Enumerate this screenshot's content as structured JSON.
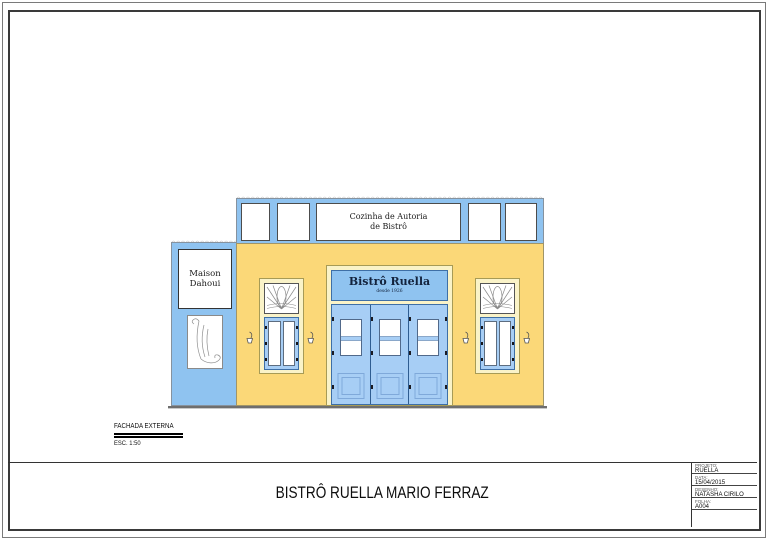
{
  "colors": {
    "blue": "#8FC3F0",
    "door_blue": "#A7CEF5",
    "yellow": "#FBD878",
    "cream": "#FAF3C8",
    "outline": "#3E6FA6"
  },
  "facade": {
    "awning_sign": {
      "line1": "Cozinha de Autoria",
      "line2": "de Bistrô"
    },
    "left_sign": {
      "line1": "Maison",
      "line2": "Dahoui"
    },
    "main_sign": {
      "name": "Bistrô Ruella",
      "subtitle": "desde 1926"
    }
  },
  "view_label": {
    "name": "FACHADA EXTERNA",
    "scale": "ESC. 1:50"
  },
  "sheet_title": "BISTRÔ RUELLA MARIO FERRAZ",
  "title_block": {
    "fields": [
      {
        "label": "PROJETO:",
        "value": "RUELLA"
      },
      {
        "label": "DATA:",
        "value": "15/04/2015"
      },
      {
        "label": "DESENHO:",
        "value": "NATASHA CIRILO"
      },
      {
        "label": "FOLHA:",
        "value": "A004"
      }
    ]
  }
}
